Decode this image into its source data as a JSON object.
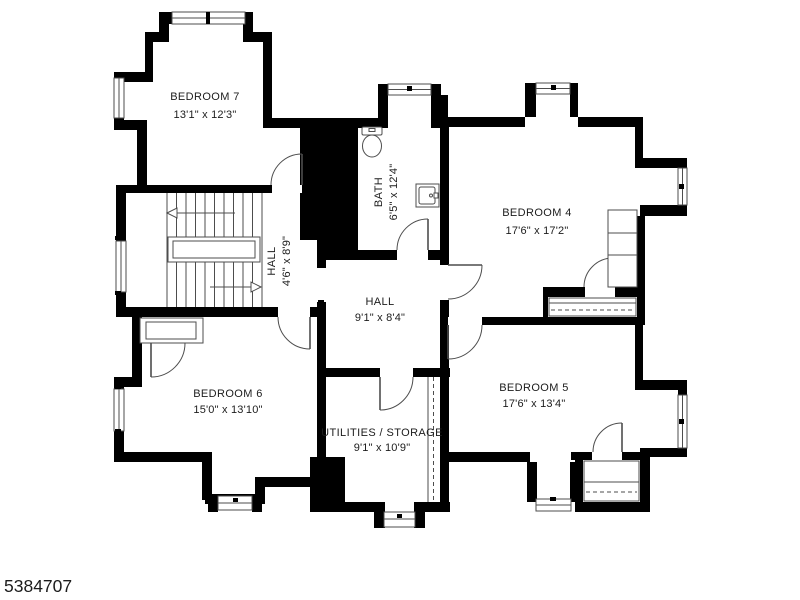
{
  "photo_id": "5384707",
  "colors": {
    "wall": "#000000",
    "line": "#4d4d4d",
    "text": "#1c1c1c",
    "background": "#ffffff"
  },
  "floorplan": {
    "type": "floor-plan",
    "rooms": [
      {
        "name": "BEDROOM 7",
        "dims": "13'1\" x 12'3\""
      },
      {
        "name": "HALL",
        "dims": "4'6\" x 8'9\""
      },
      {
        "name": "BATH",
        "dims": "6'5\" x 12'4\""
      },
      {
        "name": "BEDROOM 4",
        "dims": "17'6\" x 17'2\""
      },
      {
        "name": "HALL",
        "dims": "9'1\" x 8'4\""
      },
      {
        "name": "BEDROOM 6",
        "dims": "15'0\" x 13'10\""
      },
      {
        "name": "UTILITIES / STORAGE",
        "dims": "9'1\" x 10'9\""
      },
      {
        "name": "BEDROOM 5",
        "dims": "17'6\" x 13'4\""
      }
    ]
  }
}
